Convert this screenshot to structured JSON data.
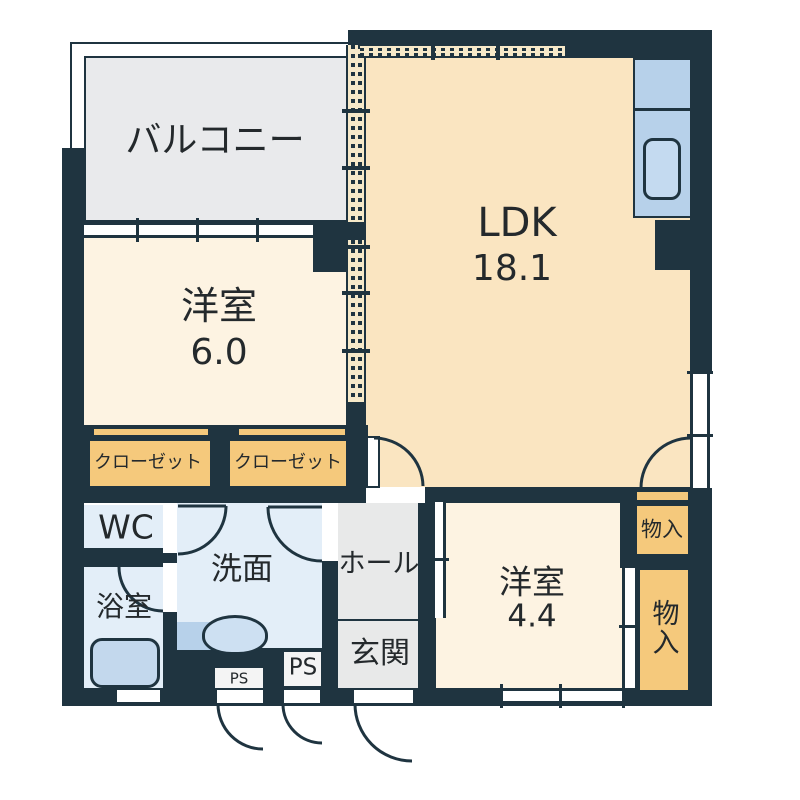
{
  "plan_title": "apartment-floor-plan",
  "colors": {
    "wall": "#1f3440",
    "ldk_floor": "#fae5c1",
    "room_floor": "#fdf3e2",
    "balcony_floor": "#e9eaec",
    "closet": "#f5c97c",
    "water_floor": "#e3eef8",
    "hall_floor": "#e8e9e9",
    "fixture": "#b7d1ea",
    "ps": "#f4f4f4"
  },
  "rooms": {
    "balcony": {
      "label": "バルコニー"
    },
    "ldk": {
      "label": "LDK",
      "area": "18.1"
    },
    "bedroom_west": {
      "label": "洋室",
      "area": "6.0"
    },
    "bedroom_south": {
      "label": "洋室",
      "area": "4.4"
    },
    "closet_left": {
      "label": "クローゼット"
    },
    "closet_right": {
      "label": "クローゼット"
    },
    "toilet": {
      "label": "WC"
    },
    "bathroom": {
      "label": "浴室"
    },
    "washroom": {
      "label": "洗面"
    },
    "hall": {
      "label": "ホール"
    },
    "entrance": {
      "label": "玄関"
    },
    "storage_upper": {
      "label": "物入"
    },
    "storage_lower": {
      "label": "物入"
    },
    "pipe_space_small": {
      "label": "PS"
    },
    "pipe_space_large": {
      "label": "PS"
    }
  }
}
